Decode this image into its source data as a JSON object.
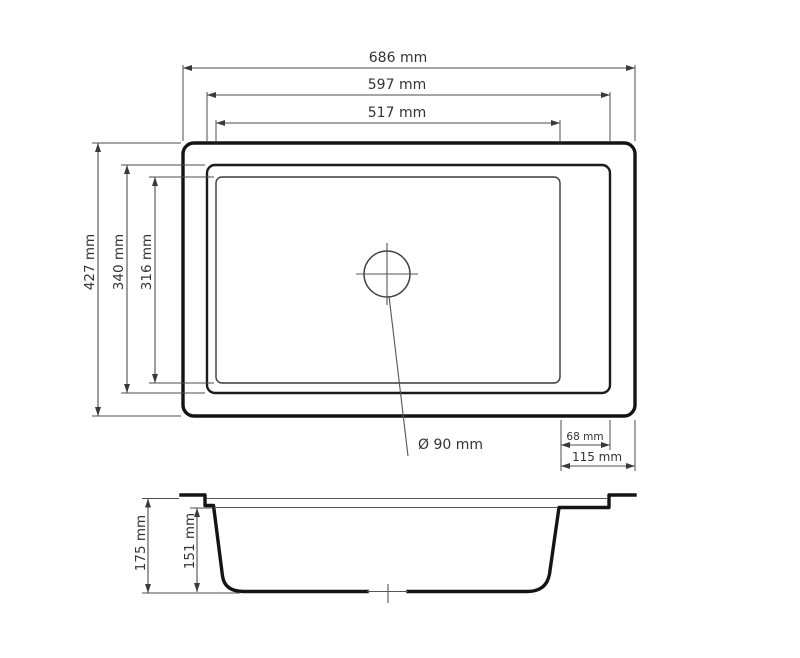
{
  "colors": {
    "background": "#ffffff",
    "outline": "#141414",
    "dim_line": "#4d4d4d",
    "text": "#333333"
  },
  "dims": {
    "outer_width": "686 mm",
    "rim_width": "597 mm",
    "bowl_width": "517 mm",
    "outer_height": "427 mm",
    "rim_height": "340 mm",
    "bowl_height": "316 mm",
    "drain_diameter": "Ø 90 mm",
    "right_rim_width": "68 mm",
    "right_edge_width": "115 mm",
    "total_depth": "175 mm",
    "bowl_depth": "151 mm"
  }
}
